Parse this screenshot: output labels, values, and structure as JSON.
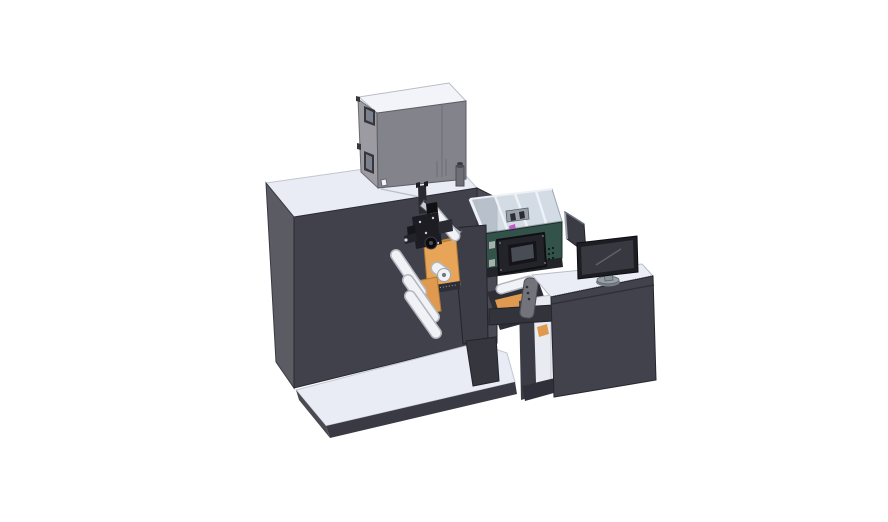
{
  "scene": {
    "description": "Isometric 3D CAD rendering of a compact label printing press line: dark main cabinet on a light base platform, gray electronics enclosure on top, orange media roll with white guide rollers and print mechanism, teal inkjet engine with clear cover and touch control panel, output ramp to an operator desk with a desktop monitor.",
    "width": 888,
    "height": 522,
    "background": "#ffffff"
  },
  "colors": {
    "background": "#ffffff",
    "surface_light": "#e9ecf4",
    "surface_lighter": "#f3f4f9",
    "cabinet_front": "#41414b",
    "cabinet_side": "#5b5b64",
    "cabinet_right": "#4a4a54",
    "platform_edge": "#3a3a44",
    "platform_side": "#4a4a52",
    "box_side": "#9b9ba1",
    "box_front": "#83838b",
    "box_frame": "#36363c",
    "box_window": "#7b818d",
    "cylinder_body": "#6e6e76",
    "cylinder_cap": "#4c4c54",
    "cover_glass": "#ccd6e0",
    "cover_strut": "#eef1f5",
    "internal_gray": "#9aa0a8",
    "magenta": "#c05ac8",
    "teal_face": "#32524a",
    "teal_underside": "#23232a",
    "teal_square": "#a8b0ac",
    "panel_dark": "#23232a",
    "screen_bezel": "#141419",
    "screen_fill": "#474c55",
    "rail_light": "#c6cad2",
    "black_part": "#1c1c22",
    "black_part2": "#2a2a31",
    "roller_white": "#f0f2f6",
    "roller_shade": "#b2b6be",
    "orange": "#e8a558",
    "orange_mid": "#e09a50",
    "orange_dark": "#c8853c",
    "band_dark": "#2e2e36",
    "tower": "#3d3d47",
    "column": "#36363f",
    "desk_top": "#eaedf5",
    "desk_front": "#42424c",
    "shelf_white": "#e8ebf2",
    "post_dark": "#3c3c46",
    "foot_dark": "#30303a",
    "handle_gray": "#73737b",
    "arm_dark": "#33333c",
    "monitor_bezel": "#1d1d24",
    "monitor_screen": "#383840",
    "stand_gray": "#9aa0a8",
    "stand_gray_dark": "#787e86",
    "side_panel": "#3b3b44"
  },
  "components": {
    "base_platform": "machine base platform",
    "main_cabinet": "main press cabinet",
    "electronics_box": "electronics enclosure with inspection windows",
    "exhaust_cylinder": "exhaust filter cylinder",
    "print_mechanism": "print head mechanism cluster",
    "guide_rail": "angled guide rail",
    "media_roll": "orange label media roll",
    "guide_rollers": "white web guide rollers",
    "frame_tower": "front frame plate",
    "printer_engine": "teal inkjet engine with clear cover",
    "control_panel": "engine control panel with screen",
    "output_ramp": "output ramp with rollers and belt",
    "clamp_handle": "rewinder clamp handle",
    "support_arm": "horizontal support arm",
    "operator_desk": "operator desk",
    "monitor": "desktop monitor on stand",
    "side_panel": "angled side panel behind monitor"
  }
}
